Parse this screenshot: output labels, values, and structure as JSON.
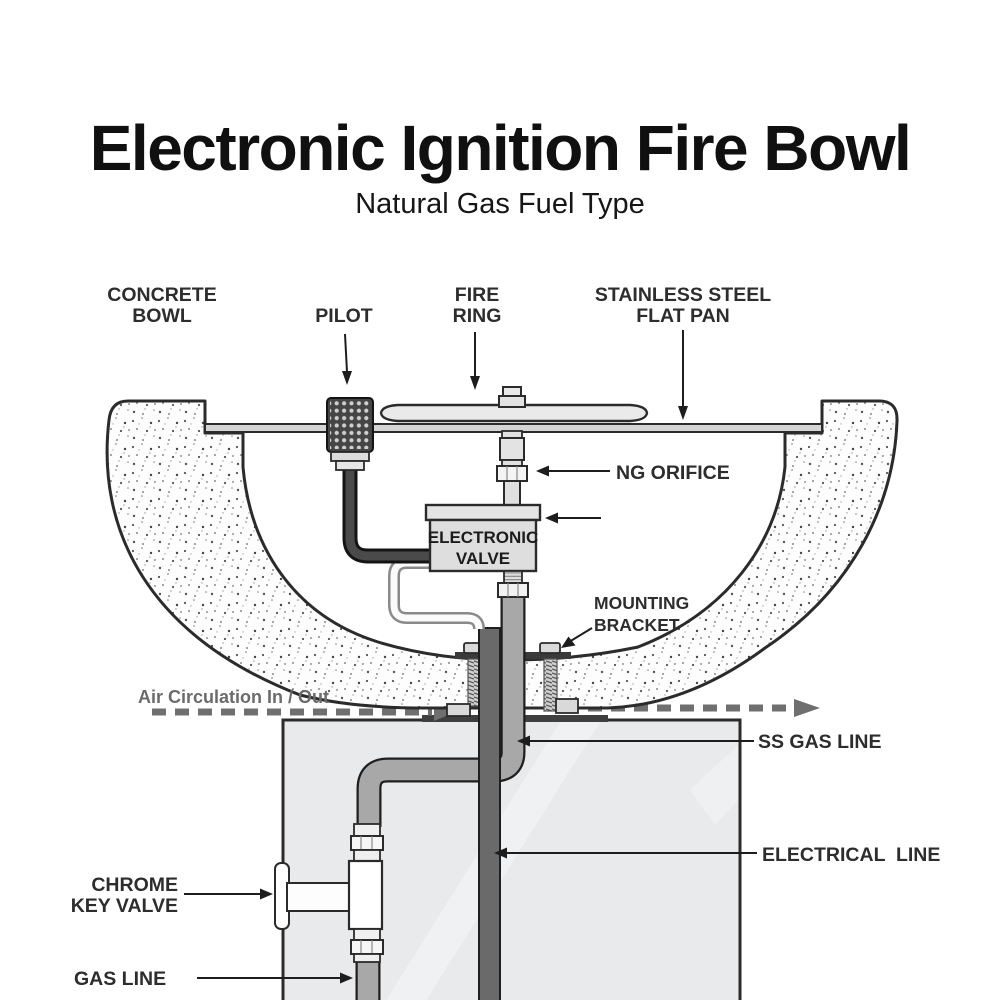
{
  "title": "Electronic Ignition Fire Bowl",
  "subtitle": "Natural Gas Fuel Type",
  "labels": {
    "concrete_bowl_1": "CONCRETE",
    "concrete_bowl_2": "BOWL",
    "pilot": "PILOT",
    "fire_ring_1": "FIRE",
    "fire_ring_2": "RING",
    "flat_pan_1": "STAINLESS STEEL",
    "flat_pan_2": "FLAT PAN",
    "ng_orifice": "NG ORIFICE",
    "electronic_valve_1": "ELECTRONIC",
    "electronic_valve_2": "VALVE",
    "mounting_bracket_1": "MOUNTING",
    "mounting_bracket_2": "BRACKET",
    "air_circulation": "Air Circulation In / Out",
    "ss_gas_line": "SS GAS LINE",
    "electrical_line": "ELECTRICAL  LINE",
    "chrome_key_valve_1": "CHROME",
    "chrome_key_valve_2": "KEY VALVE",
    "gas_line": "GAS LINE"
  },
  "colors": {
    "ink": "#2b2b2b",
    "label_text": "#2d2d2d",
    "muted_text": "#6b6b6b",
    "concrete_fill": "#fdfdfd",
    "pedestal_fill": "#e9eaeb",
    "ss_pipe": "#a8a8a8",
    "electrical_conduit": "#6a6a6a",
    "valve_box": "#dedede",
    "pilot_body": "#454545",
    "fitting_light": "#e3e3e3",
    "air_dash": "#6f6f6f"
  }
}
